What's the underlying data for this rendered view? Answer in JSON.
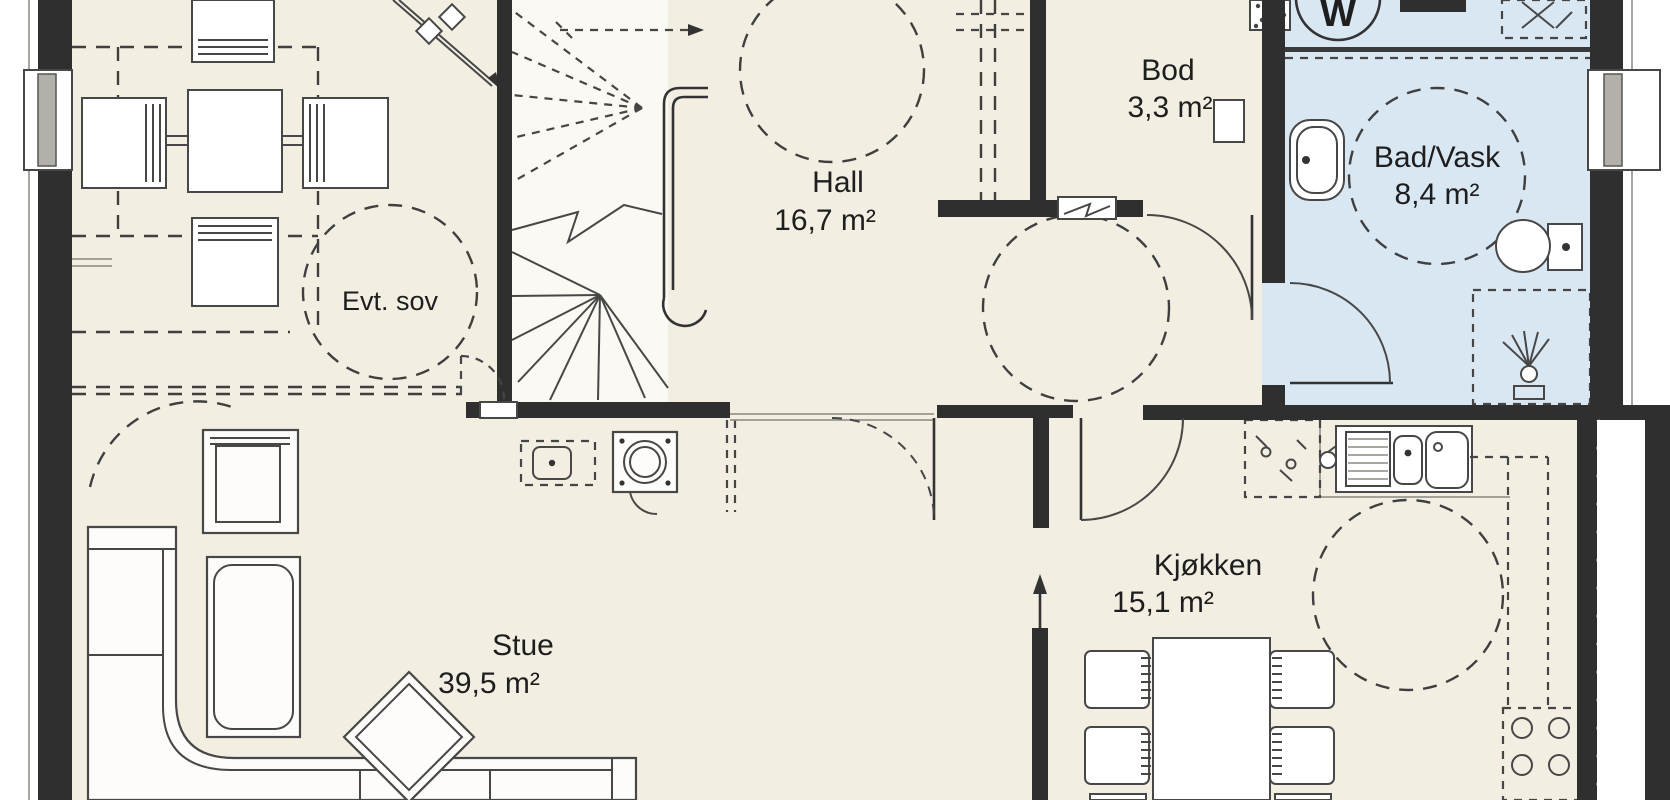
{
  "plan": {
    "type": "floor-plan",
    "language": "Norwegian",
    "rooms": {
      "hall": {
        "name": "Hall",
        "area": "16,7 m²"
      },
      "bod": {
        "name": "Bod",
        "area": "3,3 m²"
      },
      "bad_vask": {
        "name": "Bad/Vask",
        "area": "8,4 m²"
      },
      "stue": {
        "name": "Stue",
        "area": "39,5 m²"
      },
      "kjokken": {
        "name": "Kjøkken",
        "area": "15,1 m²"
      },
      "evt_sov": {
        "name": "Evt. sov"
      }
    },
    "appliances": {
      "washer_label": "W"
    },
    "colors": {
      "floor": "#f3eee2",
      "bathroom_floor": "#d9e7f3",
      "wall": "#2f2f2f",
      "outside": "#ffffff",
      "line": "#474747"
    },
    "icons": [
      "stairs-icon",
      "washing-machine-icon",
      "water-heater-icon",
      "bath-sink-icon",
      "toilet-icon",
      "shower-icon",
      "fireplace-icon",
      "kitchen-sink-icon",
      "stove-icon",
      "dishwasher-icon",
      "dining-table-icon",
      "kitchen-table-icon",
      "sofa-icon",
      "armchair-icon",
      "chaise-icon",
      "coffee-table-icon",
      "door-icon",
      "window-icon",
      "turning-circle-icon",
      "section-arrow-icon",
      "direction-arrow-icon",
      "vent-icon"
    ]
  }
}
